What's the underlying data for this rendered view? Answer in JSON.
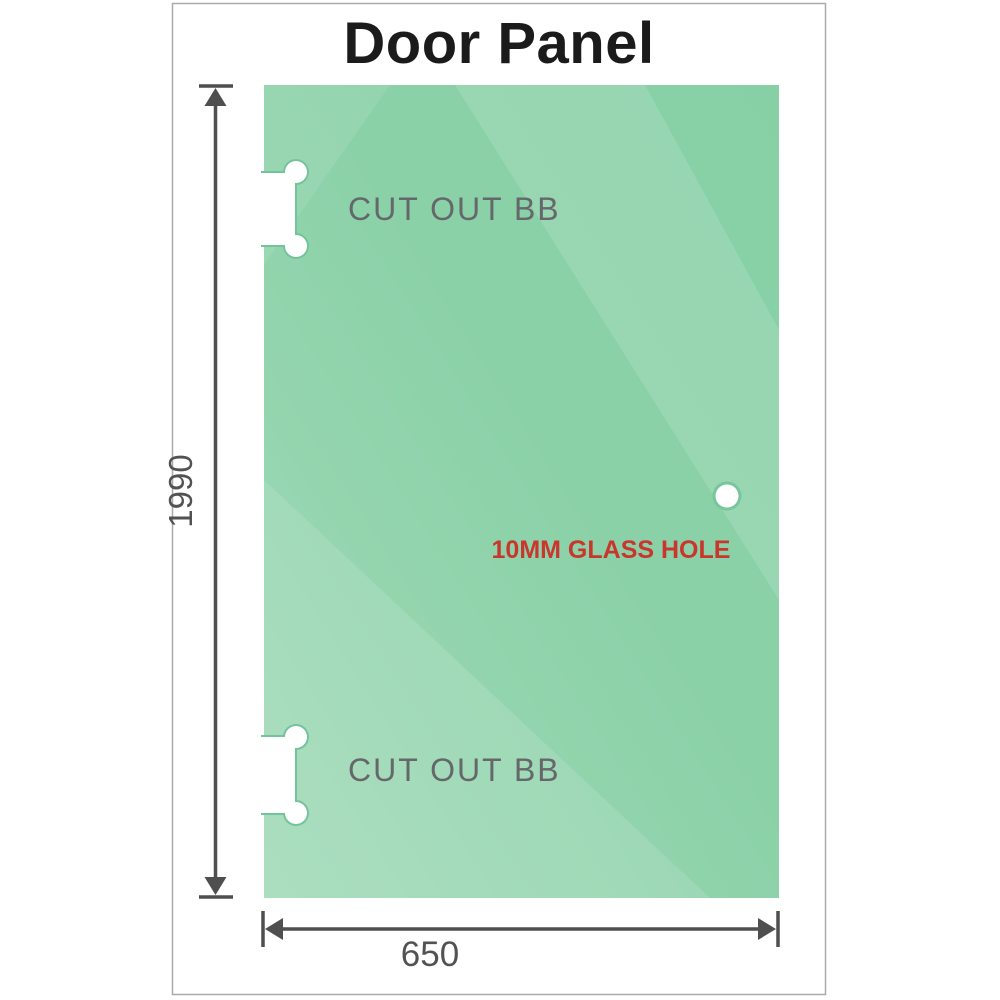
{
  "title": "Door Panel",
  "panel": {
    "cutouts": [
      {
        "label": "CUT OUT BB"
      },
      {
        "label": "CUT OUT BB"
      }
    ],
    "glass_hole_label": "10MM GLASS HOLE"
  },
  "dimensions": {
    "height_mm": "1990",
    "width_mm": "650"
  },
  "colors": {
    "glass_base": "#82cfa2",
    "glass_light": "#a6ddbd",
    "line": "#4f4f4f",
    "dim_text": "#525252",
    "cutout_label": "#65686a",
    "hole_label": "#c9362e",
    "frame_border": "#aaaaaa",
    "title": "#1b1b1b"
  }
}
